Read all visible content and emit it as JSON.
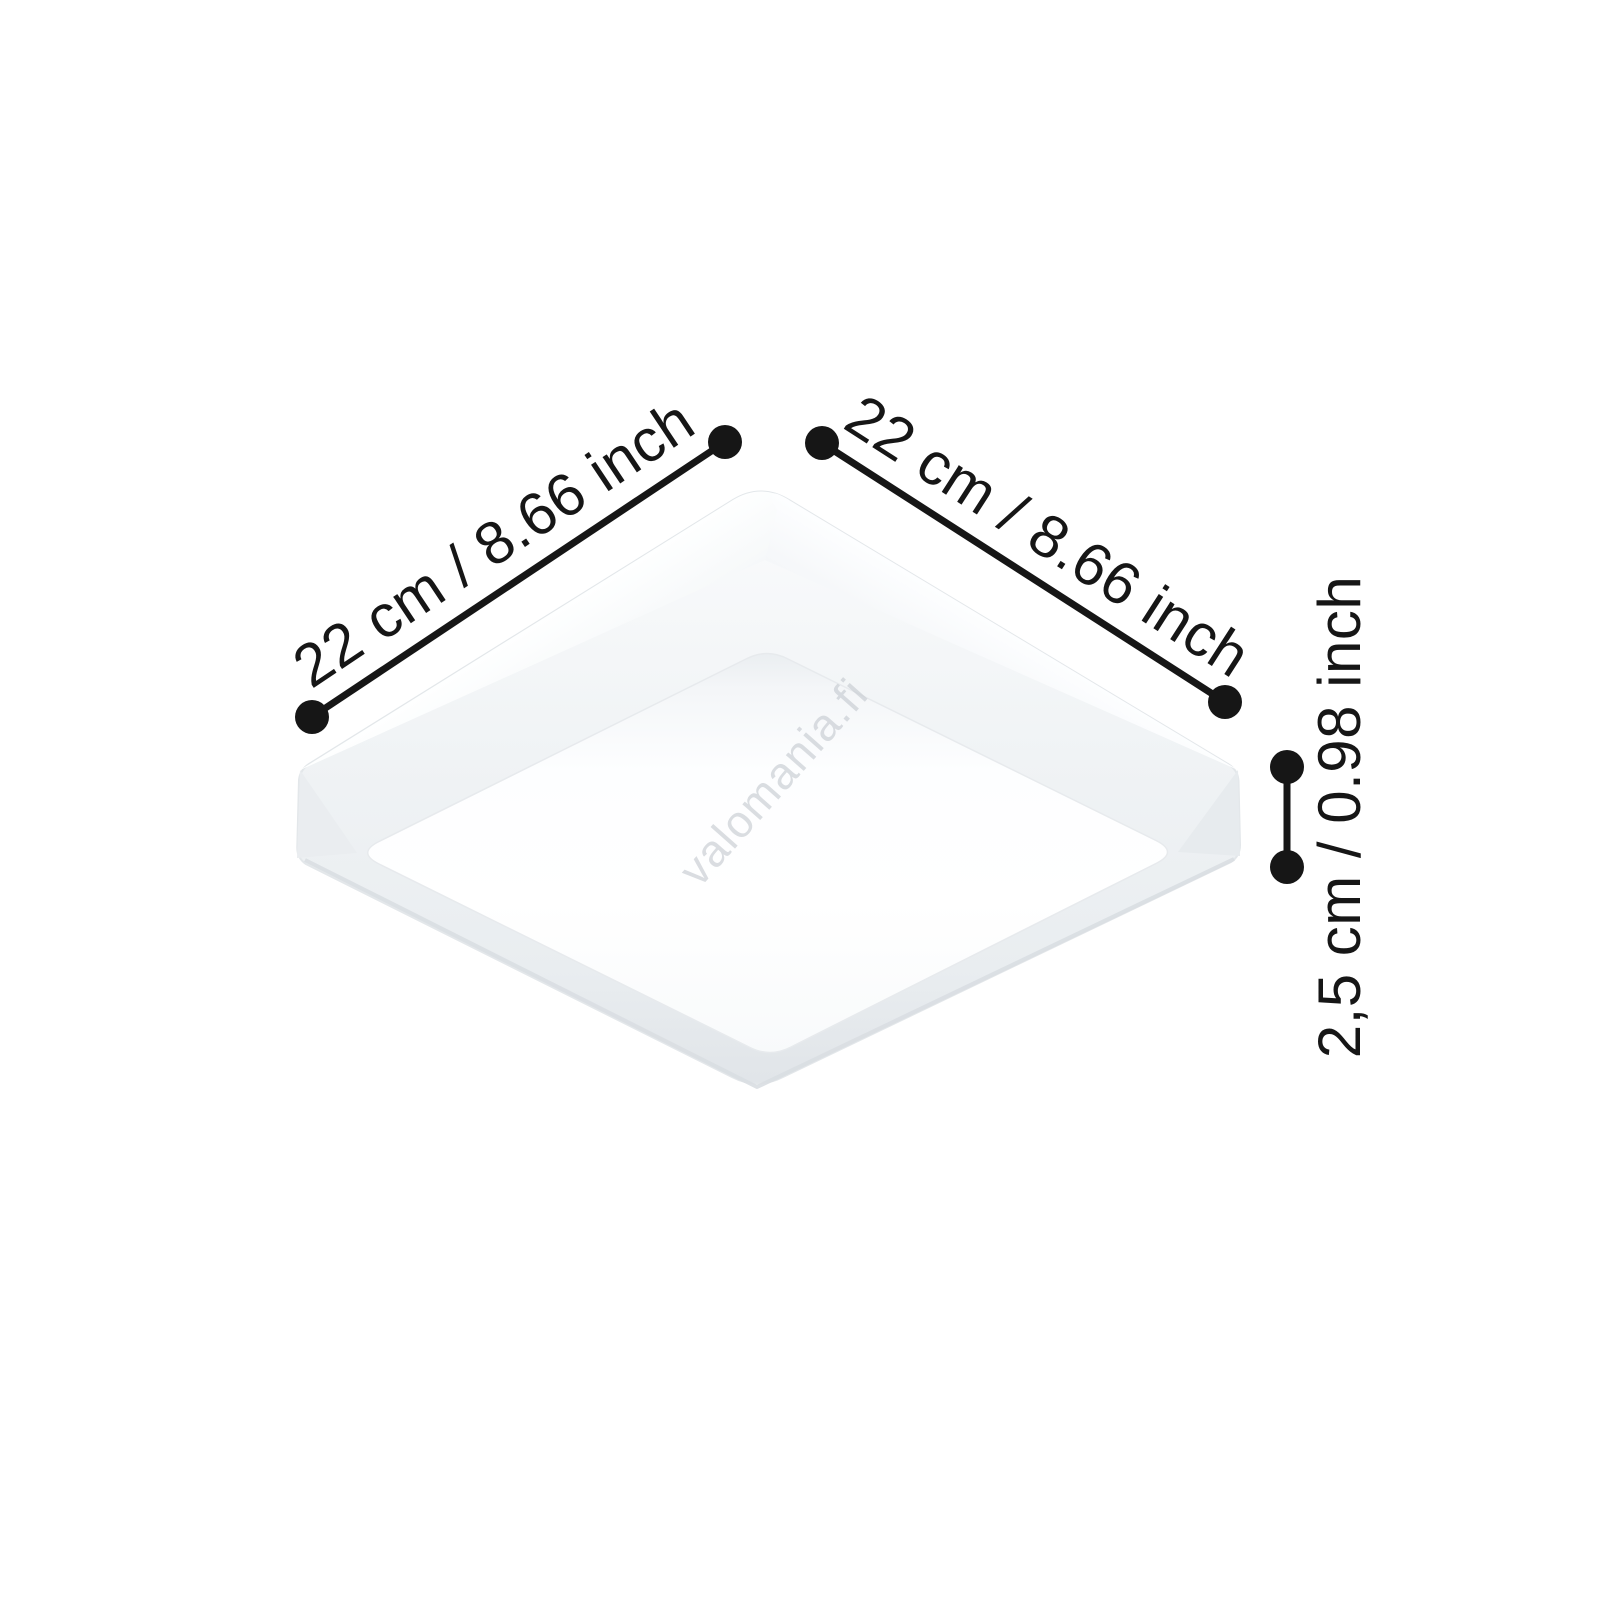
{
  "figure": {
    "description": "Dimension diagram of a white square surface-mounted LED panel ceiling light, shown tilted (diamond orientation) and viewed from below",
    "background": "#ffffff"
  },
  "watermark": {
    "text": "valomania.fi",
    "color": "#c7ccd2"
  },
  "dimensions": {
    "left_side": {
      "cm": "22",
      "inch": "8.66",
      "label": "22 cm / 8.66 inch"
    },
    "right_side": {
      "cm": "22",
      "inch": "8.66",
      "label": "22 cm / 8.66 inch"
    },
    "height": {
      "cm": "2,5",
      "inch": "0.98",
      "label": "2,5 cm / 0.98 inch"
    }
  },
  "colors": {
    "ink": "#161616",
    "frame_highlight": "#fdfeff",
    "frame_shade": "#e2e6ea",
    "diffuser": "#ffffff"
  }
}
